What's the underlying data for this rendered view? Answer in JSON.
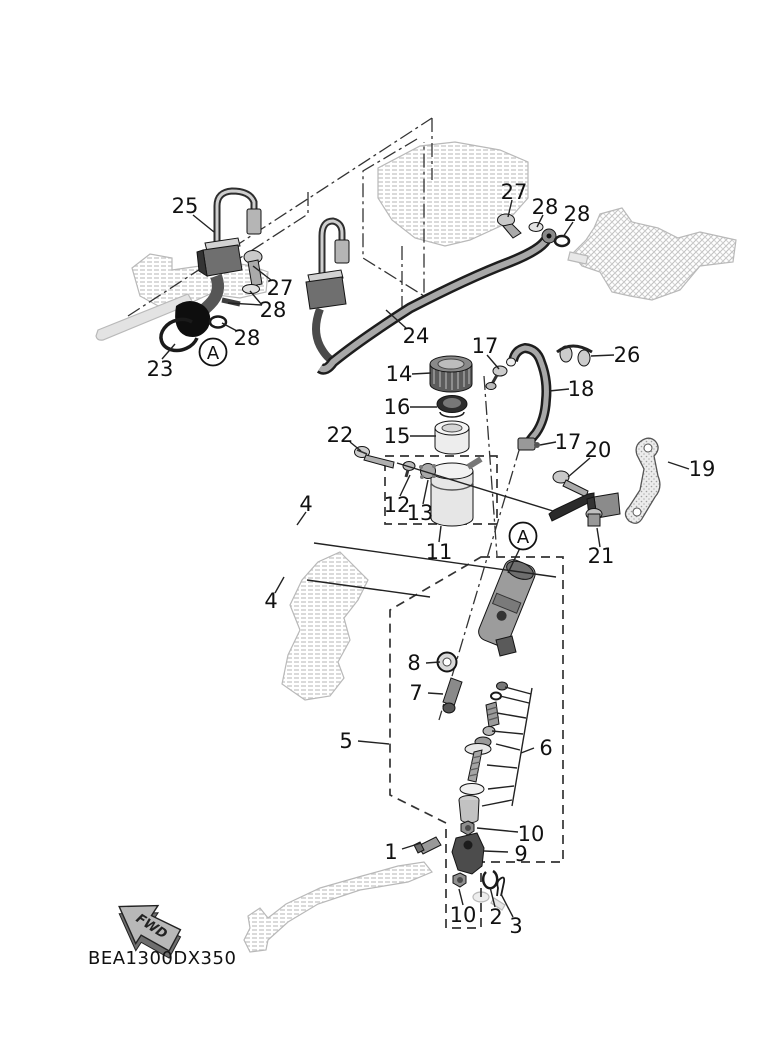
{
  "diagram": {
    "code": "BEA1300DX350",
    "fwd_arrow_label": "FWD",
    "detail_markers": [
      "A",
      "A"
    ],
    "callouts": [
      "25",
      "27",
      "28",
      "28",
      "23",
      "24",
      "27",
      "28",
      "28",
      "17",
      "26",
      "18",
      "14",
      "16",
      "15",
      "22",
      "12",
      "13",
      "11",
      "17",
      "20",
      "19",
      "21",
      "4",
      "4",
      "8",
      "7",
      "5",
      "6",
      "10",
      "1",
      "9",
      "10",
      "2",
      "3"
    ]
  }
}
